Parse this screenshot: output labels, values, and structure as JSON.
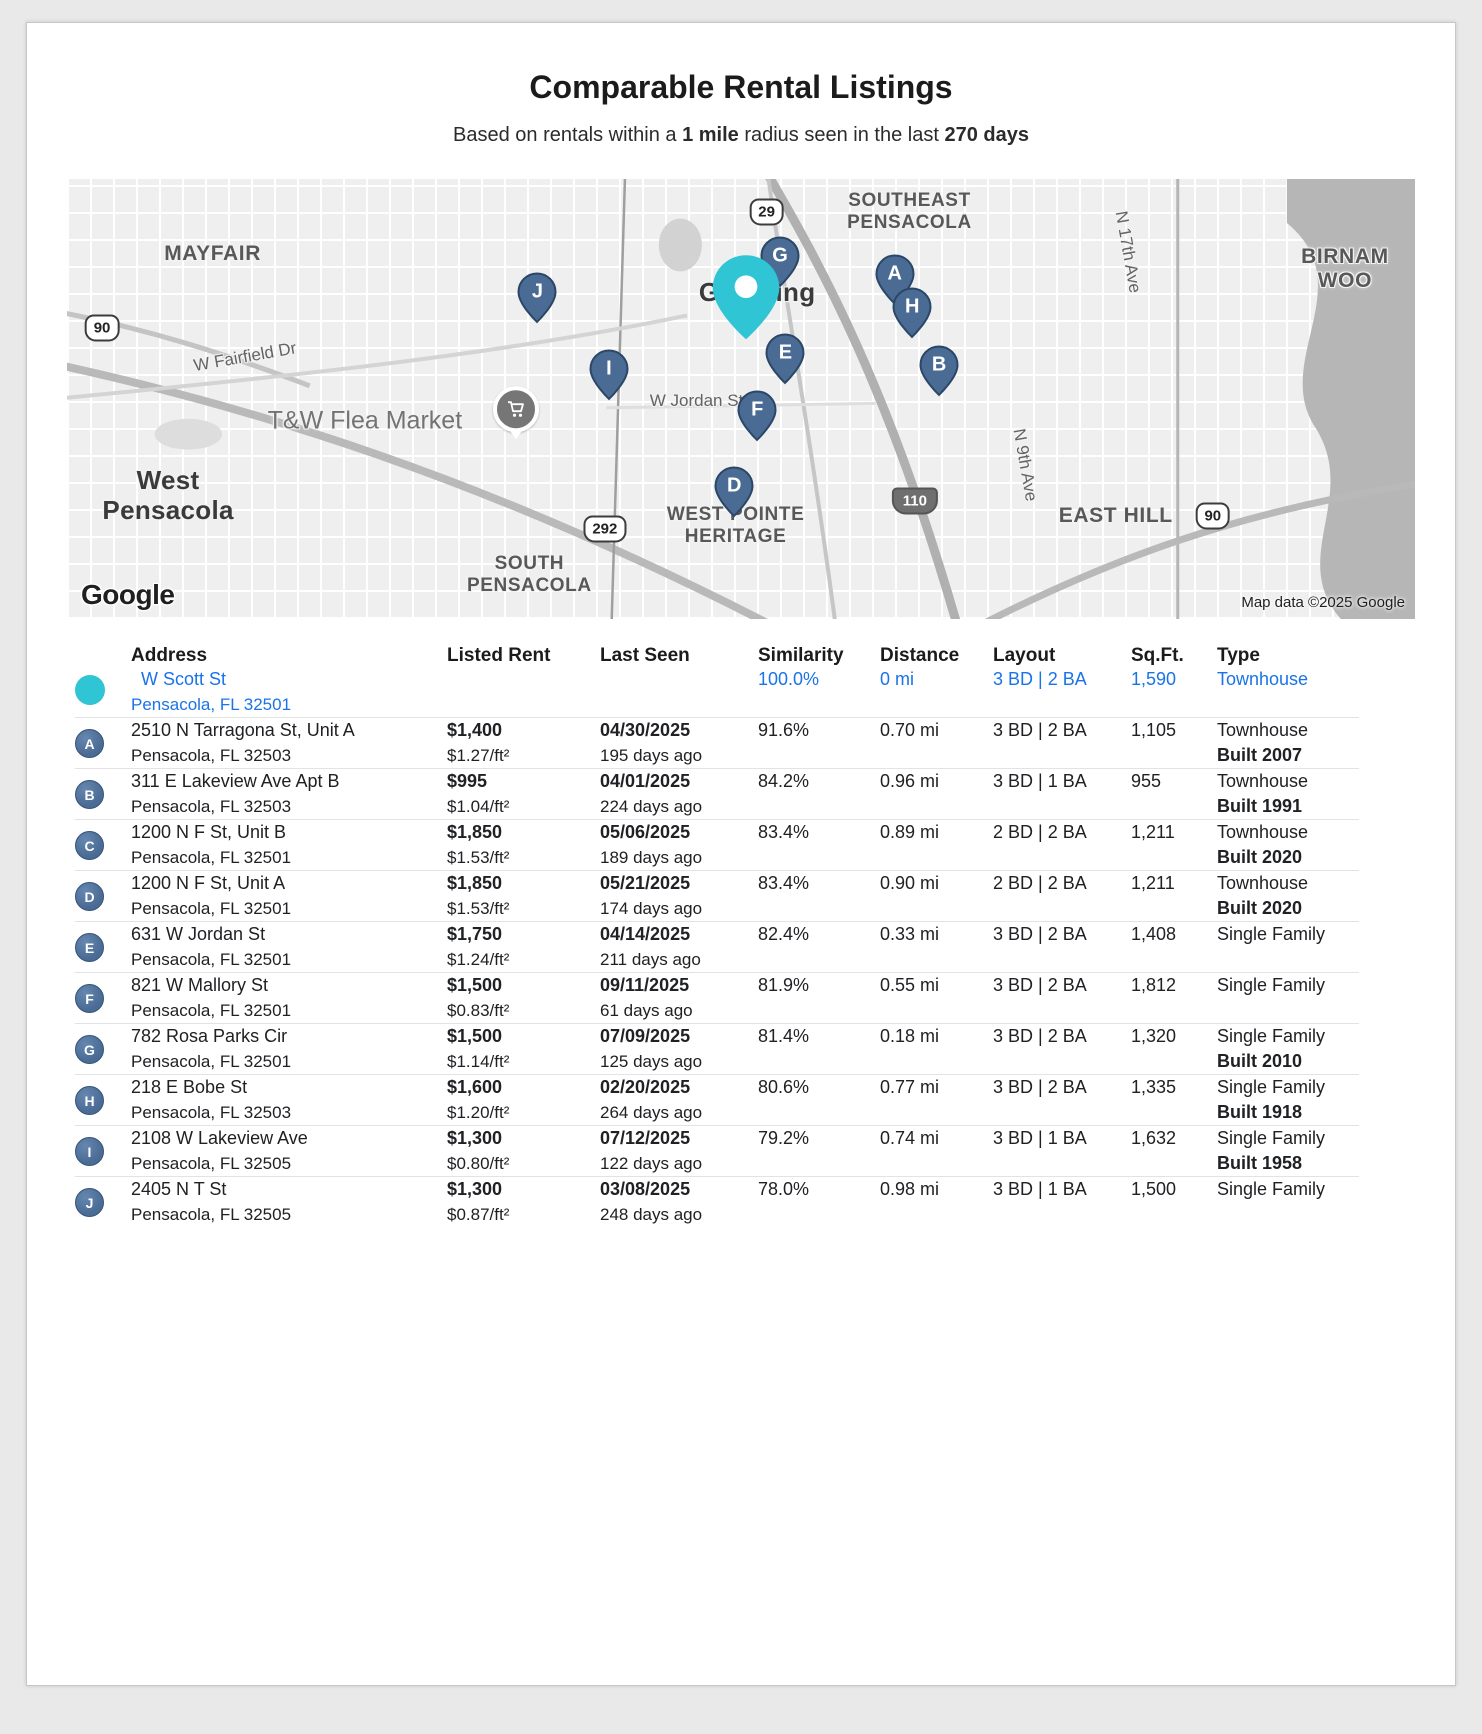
{
  "colors": {
    "accent_blue": "#1A73E8",
    "teal": "#2FC5D5",
    "marker_fill": "#4A6B94",
    "marker_stroke": "#2B4767"
  },
  "page": {
    "title": "Comparable Rental Listings",
    "subtitle": {
      "p1": "Based on rentals within a ",
      "b1": "1 mile",
      "p2": " radius seen in the last ",
      "b2": "270 days"
    }
  },
  "map": {
    "logo": "Google",
    "attribution": "Map data ©2025 Google",
    "labels": [
      {
        "name": "mayfair",
        "text": "MAYFAIR",
        "x": 10.8,
        "y": 17,
        "cls": "nbhd lg"
      },
      {
        "name": "west-pensacola",
        "text": "West\nPensacola",
        "x": 7.5,
        "y": 72,
        "cls": "city"
      },
      {
        "name": "south-pensacola",
        "text": "SOUTH\nPENSACOLA",
        "x": 34.3,
        "y": 90,
        "cls": "nbhd"
      },
      {
        "name": "southeast-pensacola",
        "text": "SOUTHEAST\nPENSACOLA",
        "x": 62.5,
        "y": 7.5,
        "cls": "nbhd"
      },
      {
        "name": "goulding",
        "text": "Goulding",
        "x": 51.2,
        "y": 25.8,
        "cls": "city"
      },
      {
        "name": "west-pointe-heritage",
        "text": "WEST POINTE\nHERITAGE",
        "x": 49.6,
        "y": 78.8,
        "cls": "nbhd"
      },
      {
        "name": "east-hill",
        "text": "EAST HILL",
        "x": 77.8,
        "y": 76.5,
        "cls": "nbhd lg"
      },
      {
        "name": "birnam-wood",
        "text": "BIRNAM WOO",
        "x": 94.8,
        "y": 20.5,
        "cls": "nbhd lg"
      },
      {
        "name": "w-fairfield-dr",
        "text": "W Fairfield Dr",
        "x": 13.2,
        "y": 40.5,
        "cls": "street",
        "rot": -10
      },
      {
        "name": "w-jordan-st",
        "text": "W Jordan St",
        "x": 46.7,
        "y": 50.5,
        "cls": "street"
      },
      {
        "name": "n-17th-ave",
        "text": "N 17th Ave",
        "x": 78.7,
        "y": 16.5,
        "cls": "street",
        "rot": 80
      },
      {
        "name": "n-9th-ave",
        "text": "N 9th Ave",
        "x": 71.1,
        "y": 65,
        "cls": "street",
        "rot": 80
      },
      {
        "name": "tw-flea-market",
        "text": "T&W Flea Market",
        "x": 22.1,
        "y": 55,
        "cls": "poi-label"
      }
    ],
    "shields": [
      {
        "text": "90",
        "x": 2.6,
        "y": 33.8,
        "kind": "us"
      },
      {
        "text": "29",
        "x": 51.9,
        "y": 7.5,
        "kind": "us"
      },
      {
        "text": "292",
        "x": 39.9,
        "y": 79.5,
        "kind": "us"
      },
      {
        "text": "110",
        "x": 62.9,
        "y": 73.2,
        "kind": "interstate"
      },
      {
        "text": "90",
        "x": 85,
        "y": 76.5,
        "kind": "us"
      }
    ],
    "poi": {
      "name": "flea-market-pin",
      "x": 33.3,
      "y": 54.3
    },
    "subject_pin": {
      "x": 50.4,
      "y": 29.5
    },
    "markers": [
      {
        "letter": "G",
        "x": 52.9,
        "y": 20.5
      },
      {
        "letter": "A",
        "x": 61.4,
        "y": 24.5
      },
      {
        "letter": "J",
        "x": 34.9,
        "y": 28.7
      },
      {
        "letter": "H",
        "x": 62.7,
        "y": 32
      },
      {
        "letter": "E",
        "x": 53.3,
        "y": 42.5
      },
      {
        "letter": "B",
        "x": 64.7,
        "y": 45.2
      },
      {
        "letter": "I",
        "x": 40.2,
        "y": 46.2
      },
      {
        "letter": "F",
        "x": 51.2,
        "y": 55.5
      },
      {
        "letter": "D",
        "x": 49.5,
        "y": 72.8
      }
    ]
  },
  "table": {
    "headers": [
      "Address",
      "Listed Rent",
      "Last Seen",
      "Similarity",
      "Distance",
      "Layout",
      "Sq.Ft.",
      "Type"
    ],
    "subject": {
      "address1": "W Scott St",
      "address2": "Pensacola, FL 32501",
      "similarity": "100.0%",
      "distance": "0 mi",
      "layout": "3 BD | 2 BA",
      "sqft": "1,590",
      "type": "Townhouse"
    },
    "listings": [
      {
        "letter": "A",
        "address1": "2510 N Tarragona St, Unit A",
        "address2": "Pensacola, FL 32503",
        "rent": "$1,400",
        "rent_sqft": "$1.27/ft²",
        "seen_date": "04/30/2025",
        "seen_ago": "195 days ago",
        "similarity": "91.6%",
        "distance": "0.70 mi",
        "layout": "3 BD | 2 BA",
        "sqft": "1,105",
        "type": "Townhouse",
        "built": "Built 2007"
      },
      {
        "letter": "B",
        "address1": "311 E Lakeview Ave Apt B",
        "address2": "Pensacola, FL 32503",
        "rent": "$995",
        "rent_sqft": "$1.04/ft²",
        "seen_date": "04/01/2025",
        "seen_ago": "224 days ago",
        "similarity": "84.2%",
        "distance": "0.96 mi",
        "layout": "3 BD | 1 BA",
        "sqft": "955",
        "type": "Townhouse",
        "built": "Built 1991"
      },
      {
        "letter": "C",
        "address1": "1200 N F St, Unit B",
        "address2": "Pensacola, FL 32501",
        "rent": "$1,850",
        "rent_sqft": "$1.53/ft²",
        "seen_date": "05/06/2025",
        "seen_ago": "189 days ago",
        "similarity": "83.4%",
        "distance": "0.89 mi",
        "layout": "2 BD | 2 BA",
        "sqft": "1,211",
        "type": "Townhouse",
        "built": "Built 2020"
      },
      {
        "letter": "D",
        "address1": "1200 N F St, Unit A",
        "address2": "Pensacola, FL 32501",
        "rent": "$1,850",
        "rent_sqft": "$1.53/ft²",
        "seen_date": "05/21/2025",
        "seen_ago": "174 days ago",
        "similarity": "83.4%",
        "distance": "0.90 mi",
        "layout": "2 BD | 2 BA",
        "sqft": "1,211",
        "type": "Townhouse",
        "built": "Built 2020"
      },
      {
        "letter": "E",
        "address1": "631 W Jordan St",
        "address2": "Pensacola, FL 32501",
        "rent": "$1,750",
        "rent_sqft": "$1.24/ft²",
        "seen_date": "04/14/2025",
        "seen_ago": "211 days ago",
        "similarity": "82.4%",
        "distance": "0.33 mi",
        "layout": "3 BD | 2 BA",
        "sqft": "1,408",
        "type": "Single Family",
        "built": ""
      },
      {
        "letter": "F",
        "address1": "821 W Mallory St",
        "address2": "Pensacola, FL 32501",
        "rent": "$1,500",
        "rent_sqft": "$0.83/ft²",
        "seen_date": "09/11/2025",
        "seen_ago": "61 days ago",
        "similarity": "81.9%",
        "distance": "0.55 mi",
        "layout": "3 BD | 2 BA",
        "sqft": "1,812",
        "type": "Single Family",
        "built": ""
      },
      {
        "letter": "G",
        "address1": "782 Rosa Parks Cir",
        "address2": "Pensacola, FL 32501",
        "rent": "$1,500",
        "rent_sqft": "$1.14/ft²",
        "seen_date": "07/09/2025",
        "seen_ago": "125 days ago",
        "similarity": "81.4%",
        "distance": "0.18 mi",
        "layout": "3 BD | 2 BA",
        "sqft": "1,320",
        "type": "Single Family",
        "built": "Built 2010"
      },
      {
        "letter": "H",
        "address1": "218 E Bobe St",
        "address2": "Pensacola, FL 32503",
        "rent": "$1,600",
        "rent_sqft": "$1.20/ft²",
        "seen_date": "02/20/2025",
        "seen_ago": "264 days ago",
        "similarity": "80.6%",
        "distance": "0.77 mi",
        "layout": "3 BD | 2 BA",
        "sqft": "1,335",
        "type": "Single Family",
        "built": "Built 1918"
      },
      {
        "letter": "I",
        "address1": "2108 W Lakeview Ave",
        "address2": "Pensacola, FL 32505",
        "rent": "$1,300",
        "rent_sqft": "$0.80/ft²",
        "seen_date": "07/12/2025",
        "seen_ago": "122 days ago",
        "similarity": "79.2%",
        "distance": "0.74 mi",
        "layout": "3 BD | 1 BA",
        "sqft": "1,632",
        "type": "Single Family",
        "built": "Built 1958"
      },
      {
        "letter": "J",
        "address1": "2405 N T St",
        "address2": "Pensacola, FL 32505",
        "rent": "$1,300",
        "rent_sqft": "$0.87/ft²",
        "seen_date": "03/08/2025",
        "seen_ago": "248 days ago",
        "similarity": "78.0%",
        "distance": "0.98 mi",
        "layout": "3 BD | 1 BA",
        "sqft": "1,500",
        "type": "Single Family",
        "built": ""
      }
    ]
  }
}
